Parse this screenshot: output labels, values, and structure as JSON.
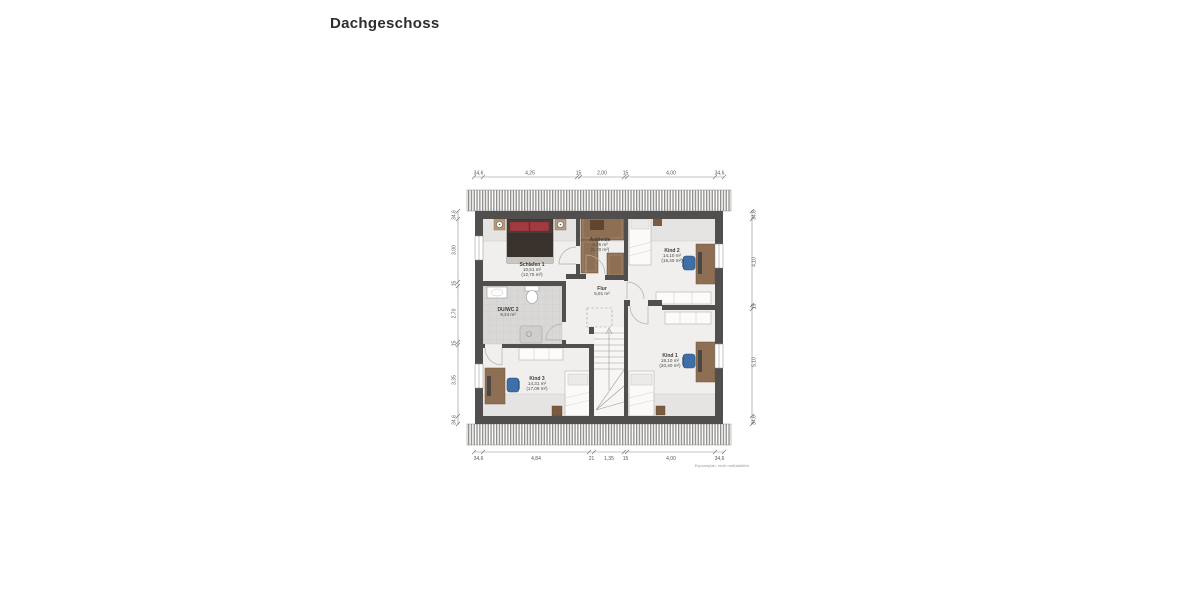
{
  "header": {
    "title": "Dachgeschoss"
  },
  "plan": {
    "footnote": "Exposéplan, nicht maßstäblich",
    "rooms": [
      {
        "name": "Schlafen 1",
        "area": "10,51 m²",
        "full": "(12,75 m²)"
      },
      {
        "name": "Ankleide",
        "area": "4,55 m²",
        "full": "(5,70 m²)"
      },
      {
        "name": "Kind 2",
        "area": "14,10 m²",
        "full": "(16,40 m²)"
      },
      {
        "name": "Flur",
        "area": "5,91 m²",
        "full": ""
      },
      {
        "name": "DU/WC 2",
        "area": "9,24 m²",
        "full": ""
      },
      {
        "name": "Kind 3",
        "area": "14,31 m²",
        "full": "(17,09 m²)"
      },
      {
        "name": "Kind 1",
        "area": "18,10 m²",
        "full": "(20,40 m²)"
      }
    ],
    "dims": {
      "top": [
        "34,6",
        "4,25",
        "15",
        "2,00",
        "15",
        "4,00",
        "34,6"
      ],
      "bottom": [
        "34,6",
        "4,84",
        "21",
        "1,35",
        "15",
        "4,00",
        "34,6"
      ],
      "left": [
        "34,6",
        "3,00",
        "15",
        "2,70",
        "15",
        "3,35",
        "34,6"
      ],
      "right": [
        "34,6",
        "4,10",
        "15",
        "5,10",
        "34,6"
      ]
    },
    "colors": {
      "wall": "#514f4d",
      "roof_hatch": "#8f8e8c",
      "floor": "#f0efed",
      "low_zone": "#e5e4e2",
      "tile": "#d9d8d6",
      "bed_dark": "#453c35",
      "pillow_red": "#a13a41",
      "wood": "#8e6f53",
      "chair_blue": "#3f6fa8"
    }
  }
}
